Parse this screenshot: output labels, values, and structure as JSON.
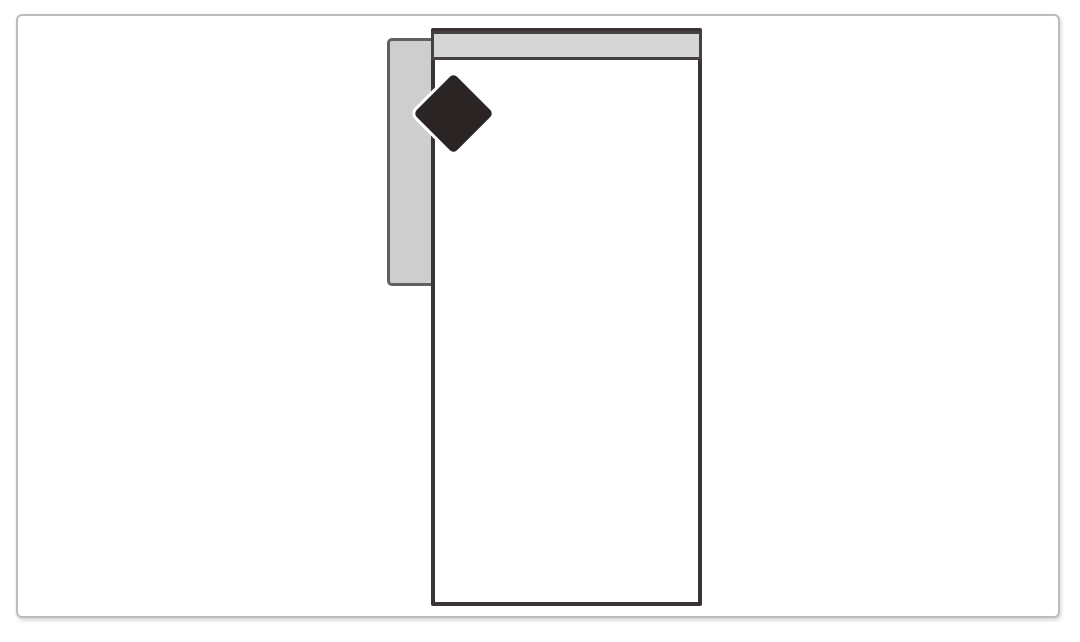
{
  "diagram": {
    "description": "Top-view schematic of a single-arm sofa / chaise module: white seat rectangle with dark outline, gray backrest bar along the top edge, gray left armrest, and a black diamond orientation marker at the top-left corner",
    "shapes": {
      "seat": {
        "label": "Seat (top view)",
        "fill": "#ffffff",
        "stroke": "#3a3436"
      },
      "backrest": {
        "label": "Backrest bar",
        "fill": "#d6d6d6",
        "stroke": "#454042"
      },
      "armrest": {
        "label": "Left armrest",
        "fill": "#cecece",
        "stroke": "#625f61",
        "position": "left"
      },
      "diamond_marker": {
        "label": "Diamond corner marker",
        "fill": "#2a2425",
        "outline": "#ffffff"
      }
    },
    "frame": {
      "label": "Image frame",
      "border_color": "#bcbcbc",
      "background": "#ffffff"
    }
  },
  "colors": {
    "canvas-bg": "#ffffff",
    "frame-border": "#bcbcbc",
    "seat-fill": "#ffffff",
    "seat-stroke": "#3a3436",
    "backrest-fill": "#d6d6d6",
    "backrest-stroke": "#454042",
    "armrest-fill": "#cecece",
    "armrest-stroke": "#625f61",
    "diamond-fill": "#2a2425",
    "diamond-halo": "#ffffff"
  }
}
